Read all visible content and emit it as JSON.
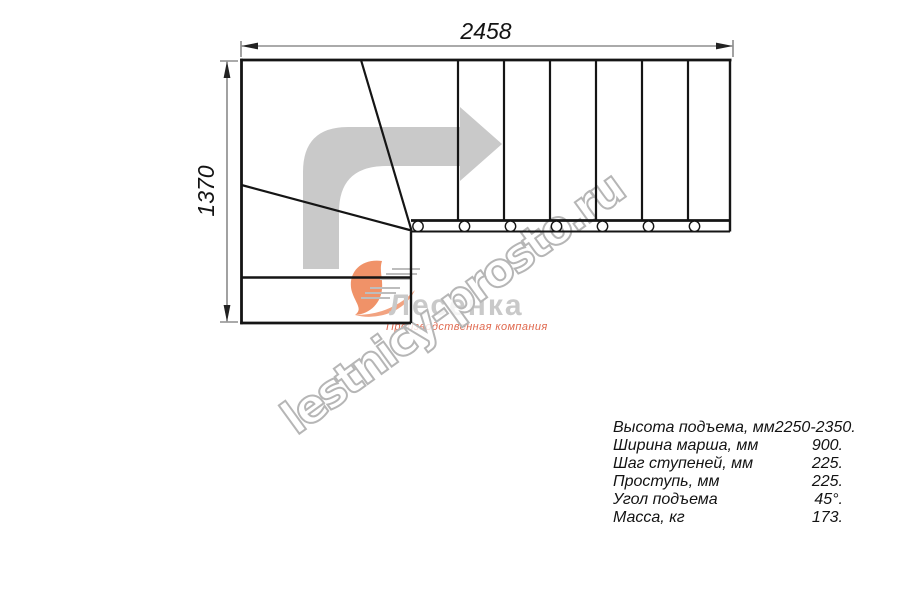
{
  "drawing": {
    "width_label": "2458",
    "height_label": "1370"
  },
  "logo": {
    "brand": "Лесенка",
    "subtitle": "Производственная компания"
  },
  "watermark": {
    "text": "lestnicy-prosto.ru"
  },
  "specs": {
    "rows": [
      {
        "label": "Высота подъема, мм",
        "value": "2250-2350."
      },
      {
        "label": "Ширина марша, мм",
        "value": "900."
      },
      {
        "label": "Шаг ступеней, мм",
        "value": "225."
      },
      {
        "label": "Проступь, мм",
        "value": "225."
      },
      {
        "label": "Угол подъема",
        "value": "45°."
      },
      {
        "label": "Масса, кг",
        "value": "173."
      }
    ]
  },
  "colors": {
    "line": "#151515",
    "dimension": "#555555",
    "arrow": "#c9c9c9",
    "logo_brand": "#c9c9c9",
    "logo_accent": "#e0694f",
    "logo_swoosh": "#f09268",
    "watermark_stroke": "#b6b6b6"
  }
}
